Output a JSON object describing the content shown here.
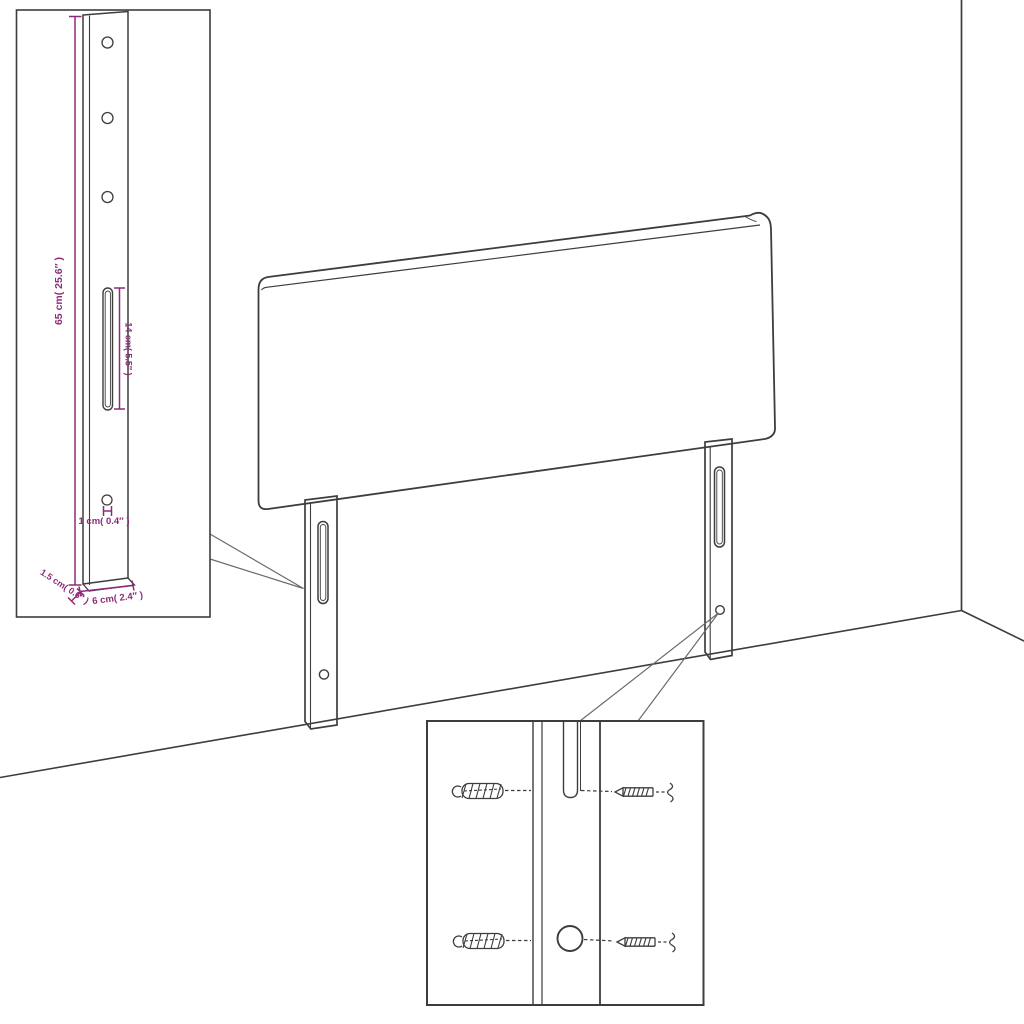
{
  "page": {
    "background": "#ffffff"
  },
  "colors": {
    "line": "#3d3d3d",
    "dimension": "#8d2b79",
    "background": "#ffffff"
  },
  "bracket_inset": {
    "dim_height": "65 cm( 25.6″ )",
    "dim_slot": "14 cm( 5.5″ )",
    "dim_hole": "1 cm( 0.4″ )",
    "dim_depth": "1.5 cm( 0.6″ )",
    "dim_width": "6 cm( 2.4″ )"
  }
}
